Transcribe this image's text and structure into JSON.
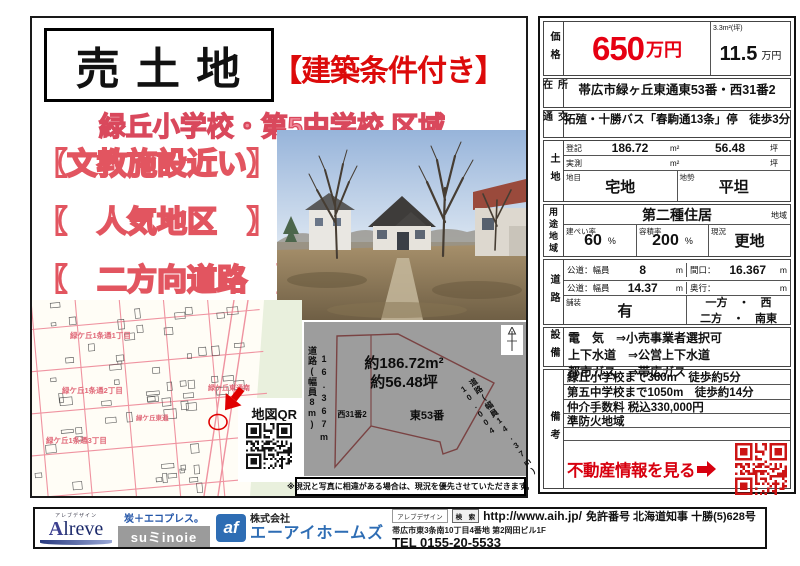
{
  "flyer": {
    "title": "売 土 地",
    "condition_badge": "【建築条件付き】",
    "subtitle": "緑丘小学校・第5中学校 区域",
    "features": [
      "【文教施設近い】",
      "【　人気地区　】",
      "【　二方向道路　】"
    ],
    "disclaimer": "※現況と写真に相違がある場合は、現況を優先させていただきます。"
  },
  "map": {
    "qr_label": "地図QR",
    "labels": [
      "緑ケ丘1条通1丁目",
      "緑ケ丘1条通2丁目",
      "緑ケ丘1条通3丁目",
      "緑ケ丘東通南",
      "緑ケ丘東通"
    ]
  },
  "plot": {
    "area_m2": "約186.72m²",
    "area_tsubo": "約56.48坪",
    "lot_main": "東53番",
    "lot_sub": "西31番2",
    "road_left": "道路(幅員8m)",
    "frontage_left": "16.367m",
    "frontage_right": "10.004",
    "road_right": "道路(幅員14.37m)"
  },
  "table": {
    "price": {
      "label": "価格",
      "value": "650",
      "unit": "万円",
      "per_caption": "3.3m²(坪)",
      "per_value": "11.5",
      "per_unit": "万円"
    },
    "location": {
      "label": "所在",
      "value": "帯広市緑ヶ丘東通東53番・西31番2"
    },
    "access": {
      "label": "交通",
      "value": "拓殖・十勝バス「春駒通13条」停　徒歩3分"
    },
    "land": {
      "label": "土地",
      "registered_label": "登記",
      "registered_m2": "186.72",
      "m2_unit": "m²",
      "registered_tsubo": "56.48",
      "tsubo_unit": "坪",
      "measured_label": "実測",
      "category_label": "地目",
      "category": "宅地",
      "terrain_label": "地勢",
      "terrain": "平坦"
    },
    "zoning": {
      "label": "用途地域",
      "zone": "第二種住居",
      "zone_suffix": "地域",
      "bcr_label": "建ぺい率",
      "bcr": "60",
      "bcr_unit": "%",
      "far_label": "容積率",
      "far": "200",
      "far_unit": "%",
      "status_label": "現況",
      "status": "更地"
    },
    "road": {
      "label": "道路",
      "r1_label": "公道：幅員",
      "r1_value": "8",
      "r1_unit": "m",
      "frontage_label": "間口：",
      "frontage_value": "16.367",
      "frontage_unit": "m",
      "r2_label": "公道：幅員",
      "r2_value": "14.37",
      "r2_unit": "m",
      "depth_label": "奥行：",
      "depth_value": "",
      "depth_unit": "m",
      "paving_label": "舗装",
      "paving": "有",
      "dir_lines": [
        "一方　・　西",
        "二方　・　南東"
      ]
    },
    "utilities": {
      "label": "設備",
      "lines": [
        "電　気　⇒小売事業者選択可",
        "上下水道　⇒公営上下水道",
        "都市ガス　⇒帯広ガス"
      ]
    },
    "notes": {
      "label": "備考",
      "lines": [
        "緑丘小学校まで360m　徒歩約5分",
        "第五中学校まで1050m　徒歩約14分",
        "仲介手数料 税込330,000円",
        "準防火地域"
      ],
      "cta": "不動産情報を見る"
    }
  },
  "footer": {
    "alreve_kana": "アレブデザイン",
    "alreve_initial": "A",
    "alreve_rest": "lreve",
    "eco_tag": "炭＋エコプレス。",
    "suminoie": "suミinoie",
    "af_mark": "af",
    "company_prefix": "株式会社",
    "company_name": "エーアイホームズ",
    "search_label": "アレブデザイン",
    "search_button": "検　索",
    "url": "http://www.aih.jp/",
    "license": "免許番号 北海道知事 十勝(5)628号",
    "address": "帯広市東3条南10丁目4番地 第2岡田ビル1F",
    "tel": "TEL 0155-20-5533"
  },
  "colors": {
    "accent_red": "#e60012",
    "cta_red": "#d7000f",
    "subtitle_pink": "#f28b9b",
    "feature_stroke": "#e25560",
    "map_road_pink": "#ef93a0",
    "footer_navy": "#1c2a6b",
    "footer_blue": "#2e6db4",
    "plot_gray": "#9d9d9d"
  }
}
